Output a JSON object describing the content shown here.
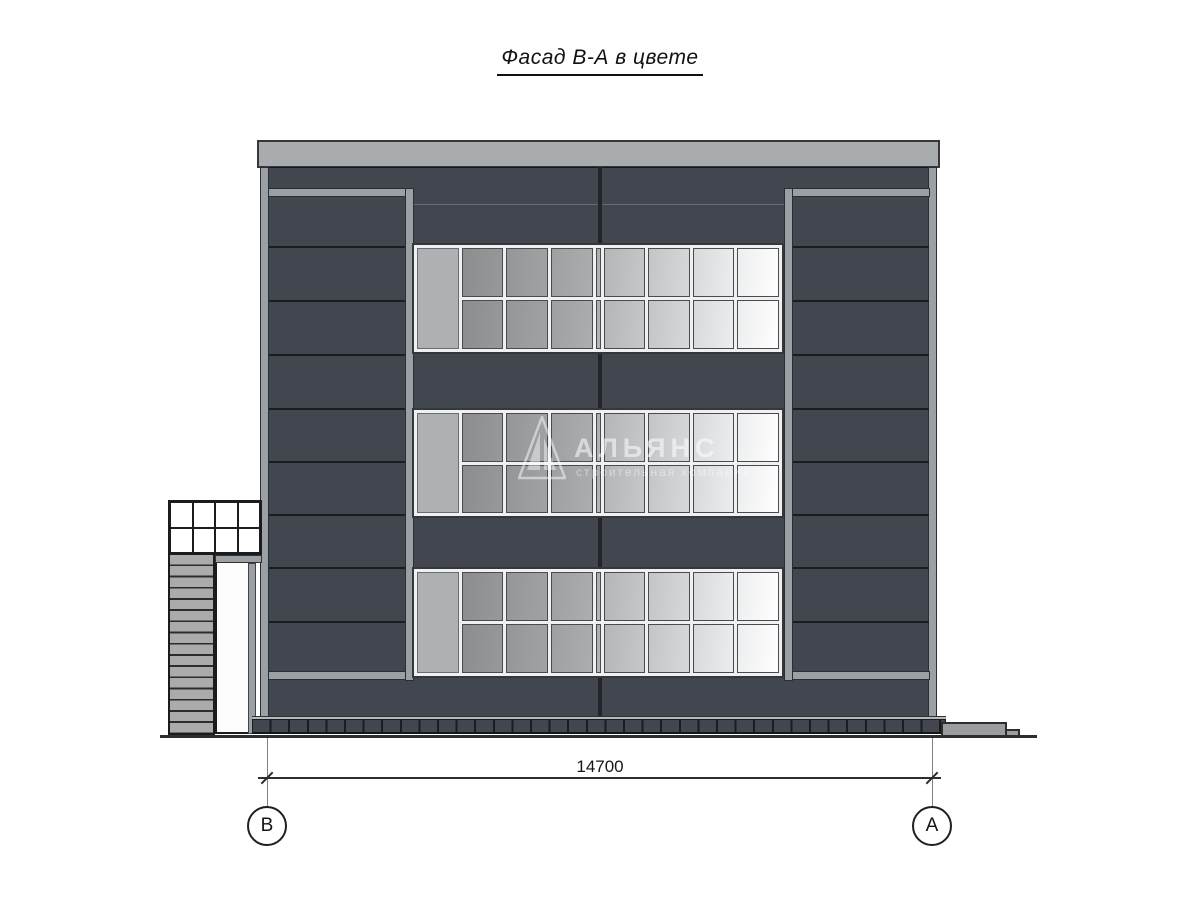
{
  "title": "Фасад В-А в цвете",
  "watermark": {
    "name": "АЛЬЯНС",
    "tagline": "строительная компания"
  },
  "dimension": {
    "label": "14700"
  },
  "axes": {
    "left": "В",
    "right": "А"
  },
  "building": {
    "window_bands": 3,
    "window_columns": 8,
    "window_rows": 2,
    "canopy_columns": 4,
    "canopy_rows": 2,
    "louver_bar_count": 16,
    "plinth_segment_count": 37
  },
  "colors": {
    "facade_panel": "#42464f",
    "trim_gray": "#9aa0a4",
    "roof_cap": "#a9acae",
    "seam_dark": "#1a1c20",
    "glass_dark": "#8b8d8f",
    "glass_light": "#fefefe",
    "ground_line": "#2c2e30"
  }
}
